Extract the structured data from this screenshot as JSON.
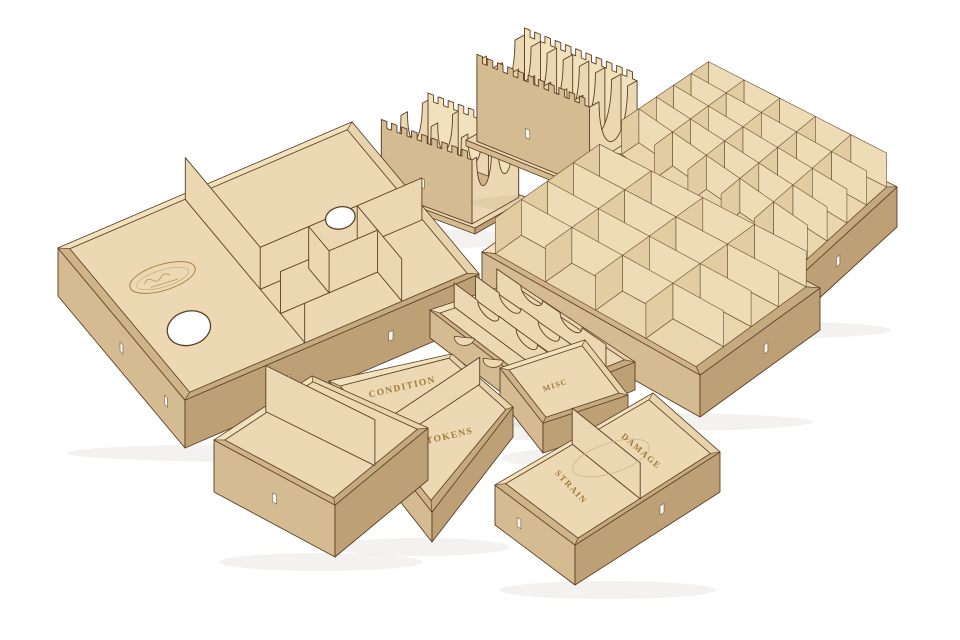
{
  "scene": {
    "subject": "Laser-cut plywood board game organizer insert set: open trays, gridded token trays and scalloped card holders arranged on a white background",
    "background": "#ffffff",
    "material": "natural birch plywood",
    "item_count": 10
  },
  "palette": {
    "background": "#ffffff",
    "outline": "#5b3f24",
    "floor": "#ecd9b4",
    "floor_cell": "#e9d5ae",
    "rim": "#d8bf97",
    "rim_near": "#cfb48a",
    "rim_near_b": "#c6aa7f",
    "inner_left": "#f1e1bd",
    "inner_right": "#e8d4ac",
    "wall_left": "#d5bb91",
    "wall_right": "#bda076",
    "divider": "#ebd8b2",
    "cell_face_left": "#eedcb6",
    "cell_face_right": "#e2cda3",
    "engraving": "#9c7331",
    "slot": "#f8f5ee",
    "shadow": "rgba(110,90,60,0.08)",
    "faint_burn": "#c9b68d"
  },
  "engraved_labels": {
    "condition": "CONDITION",
    "id_tokens": "ID TOKENS",
    "misc": "MISC",
    "damage": "DAMAGE",
    "strain": "STRAIN"
  },
  "logo_stamp": {
    "shape": "engraved oval maker's mark",
    "text_legible": false
  },
  "items": [
    {
      "name": "card-holder-small",
      "label": null,
      "features": "comb-top walls, two columns of scalloped card dividers"
    },
    {
      "name": "card-holder-large",
      "label": null,
      "features": "comb-top walls, eight scalloped card divider fins"
    },
    {
      "name": "grid-tray-25",
      "label": null,
      "features": "5 x 5 token compartments"
    },
    {
      "name": "large-tray",
      "label": null,
      "features": "mixed compartments, two oval finger holes, engraved logo stamp"
    },
    {
      "name": "grid-tray-16",
      "label": null,
      "features": "4 x 4 token compartments"
    },
    {
      "name": "row-tray",
      "label": null,
      "features": "four card rows with notched dividers"
    },
    {
      "name": "misc-tray",
      "label": "MISC",
      "features": "single shallow compartment"
    },
    {
      "name": "condition-id-tokens-tray",
      "label": "CONDITION / ID TOKENS",
      "features": "two compartments"
    },
    {
      "name": "open-two-compartment-tray",
      "label": null,
      "features": "deep tray, two compartments"
    },
    {
      "name": "strain-damage-tray",
      "label": "STRAIN / DAMAGE",
      "features": "two compartments, faint engraved circle"
    }
  ]
}
